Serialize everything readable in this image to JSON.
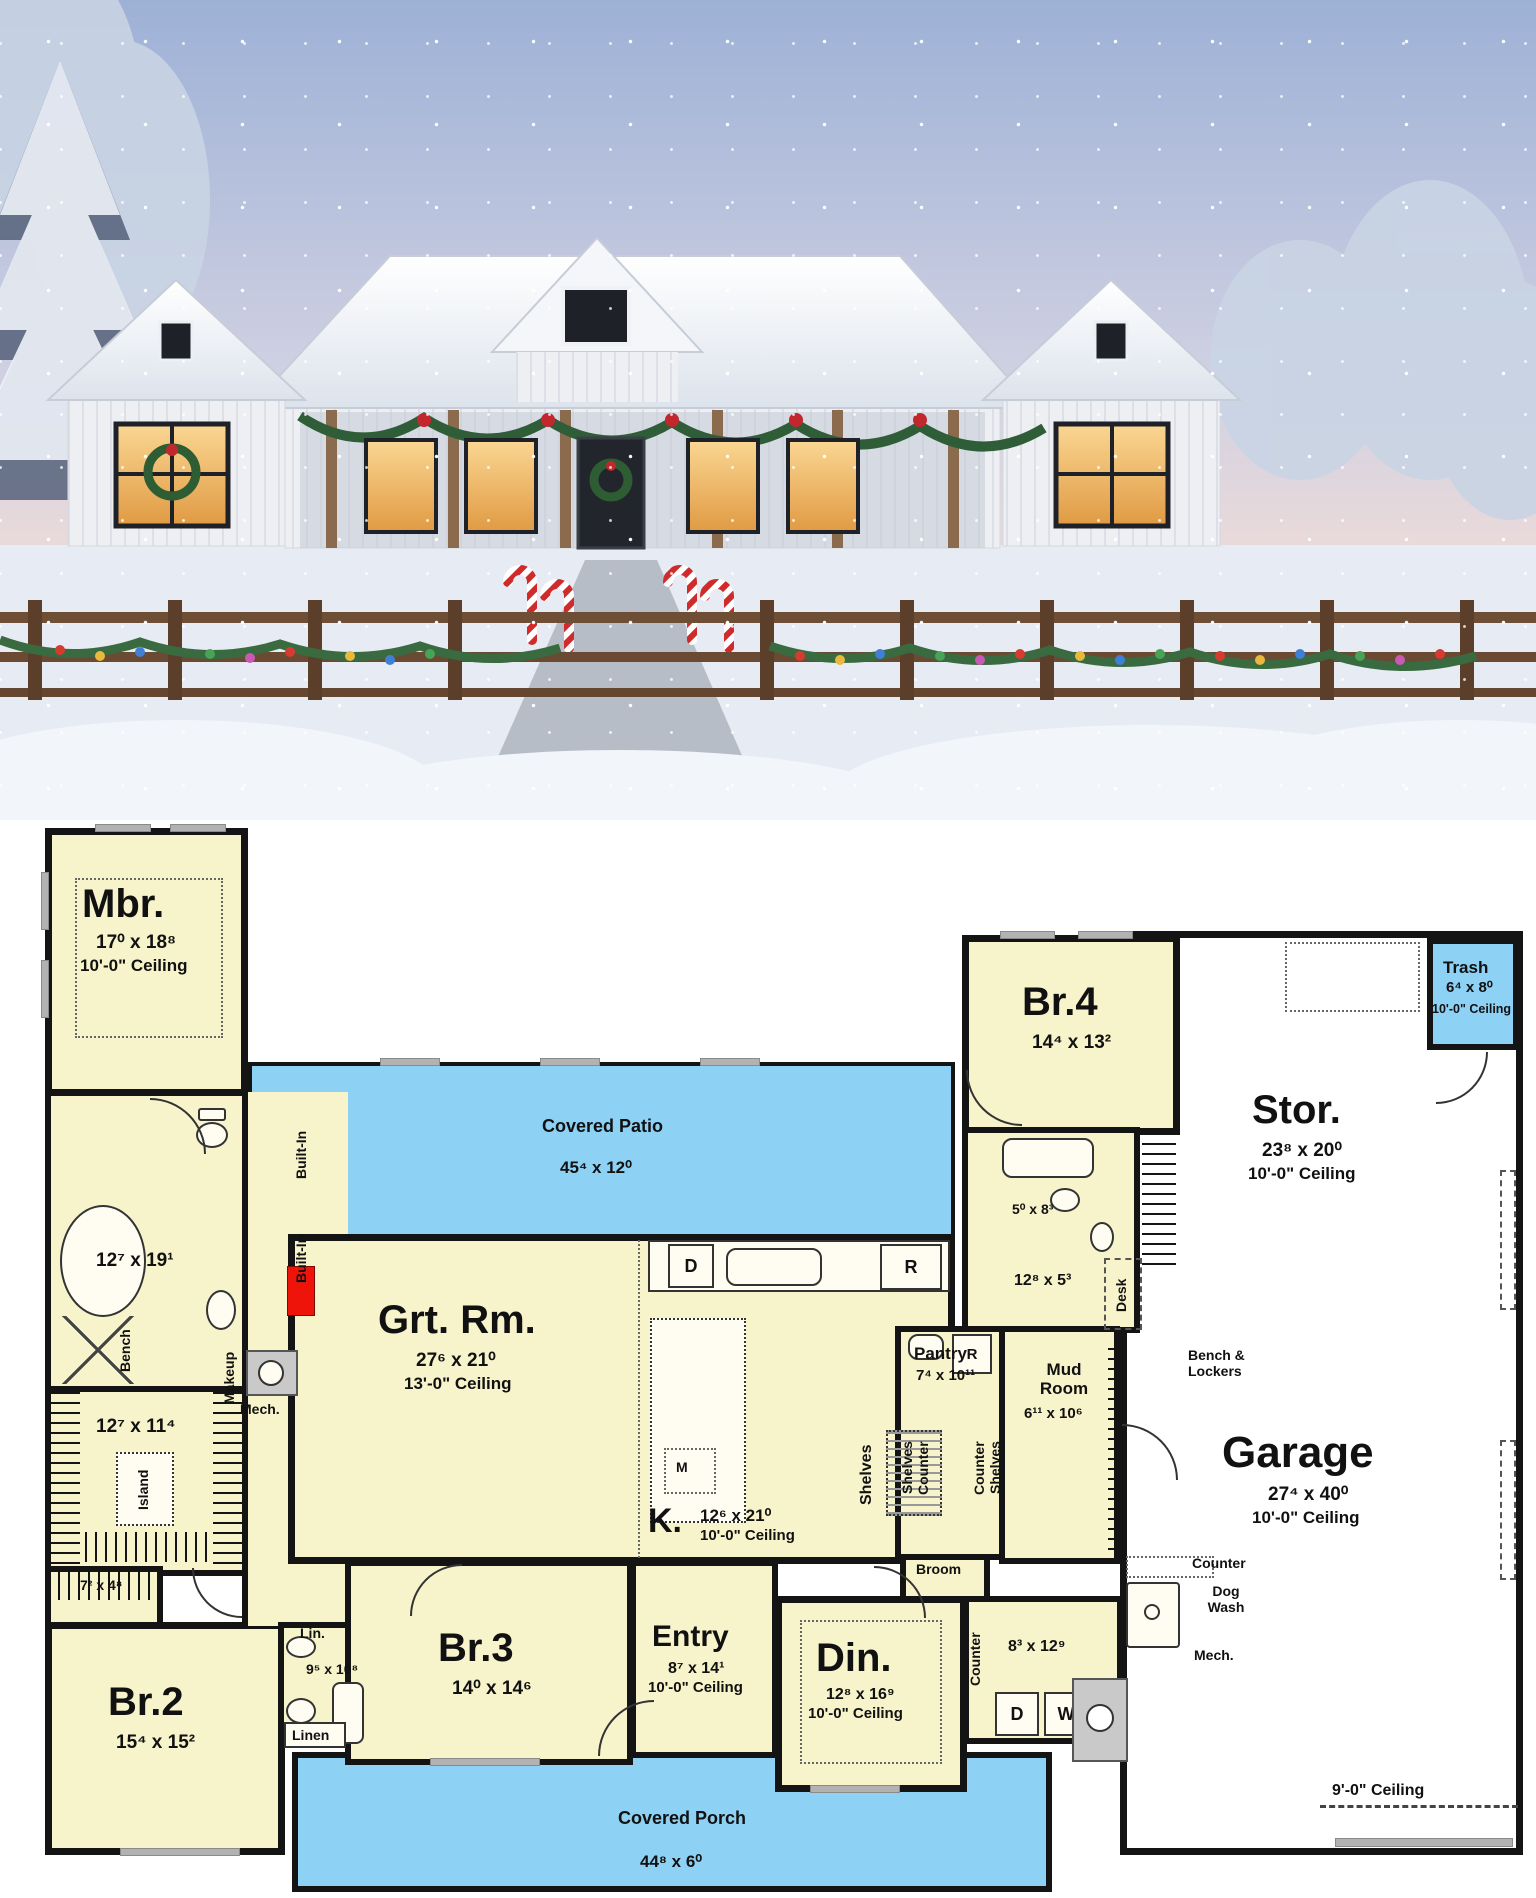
{
  "photo": {
    "scene": "snow-covered modern farmhouse at dusk with christmas decorations",
    "colors": {
      "sky_top": "#9db1d6",
      "sky_horizon": "#f0dcd8",
      "snow": "#e9edf4",
      "house": "#eef0f3",
      "warm_window": "#f3bc6a",
      "garland": "#2f5d38",
      "fence": "#6f4e36"
    }
  },
  "plan": {
    "colors": {
      "room_fill": "#f7f3cb",
      "outdoor_fill": "#8dd1f5",
      "garage_fill": "#ffffff",
      "wall": "#141414"
    },
    "rooms": {
      "mbr": {
        "name": "Mbr.",
        "dims": "17⁰ x 18⁸",
        "ceiling": "10'-0\" Ceiling"
      },
      "patio": {
        "name": "Covered Patio",
        "dims": "45⁴ x 12⁰"
      },
      "br4": {
        "name": "Br.4",
        "dims": "14⁴ x 13²"
      },
      "trash": {
        "name": "Trash",
        "dims": "6⁴ x 8⁰",
        "ceiling": "10'-0\" Ceiling"
      },
      "stor": {
        "name": "Stor.",
        "dims": "23⁸ x 20⁰",
        "ceiling": "10'-0\" Ceiling"
      },
      "garage": {
        "name": "Garage",
        "dims": "27⁴ x 40⁰",
        "ceiling": "10'-0\" Ceiling",
        "rear_note": "9'-0\" Ceiling"
      },
      "grt": {
        "name": "Grt. Rm.",
        "dims": "27⁶ x 21⁰",
        "ceiling": "13'-0\" Ceiling"
      },
      "kitchen": {
        "name": "K.",
        "dims": "12⁶ x 21⁰",
        "ceiling": "10'-0\" Ceiling"
      },
      "pantry": {
        "name": "Pantry",
        "dims": "7⁴ x 10¹¹"
      },
      "mud": {
        "name": "Mud Room",
        "dims": "6¹¹ x 10⁶"
      },
      "mbath": {
        "dims": "12⁷ x 19¹"
      },
      "wic": {
        "dims": "12⁷ x 11⁴"
      },
      "closet2": {
        "dims": "7² x 4⁸"
      },
      "br2": {
        "name": "Br.2",
        "dims": "15⁴ x 15²"
      },
      "br3": {
        "name": "Br.3",
        "dims": "14⁰ x 14⁶"
      },
      "bath2": {
        "dims": "9⁵ x 10⁸"
      },
      "br4bath": {
        "dims": "5⁰ x 8³"
      },
      "hall4": {
        "dims": "12⁸ x 5³"
      },
      "entry": {
        "name": "Entry",
        "dims": "8⁷ x 14¹",
        "ceiling": "10'-0\" Ceiling"
      },
      "din": {
        "name": "Din.",
        "dims": "12⁸ x 16⁹",
        "ceiling": "10'-0\" Ceiling"
      },
      "laundry": {
        "dims": "8³ x 12⁹"
      },
      "porch": {
        "name": "Covered Porch",
        "dims": "44⁸ x 6⁰"
      }
    },
    "annotations": {
      "makeup": "Makeup",
      "bench": "Bench",
      "island": "Island",
      "built_in": "Built-In",
      "mech": "Mech.",
      "shelves": "Shelves",
      "counter": "Counter",
      "desk": "Desk",
      "bench_lockers": "Bench & Lockers",
      "broom": "Broom",
      "dog_wash": "Dog Wash",
      "lin": "Lin.",
      "linen": "Linen",
      "d": "D",
      "w": "W",
      "r": "R",
      "m": "M"
    }
  }
}
